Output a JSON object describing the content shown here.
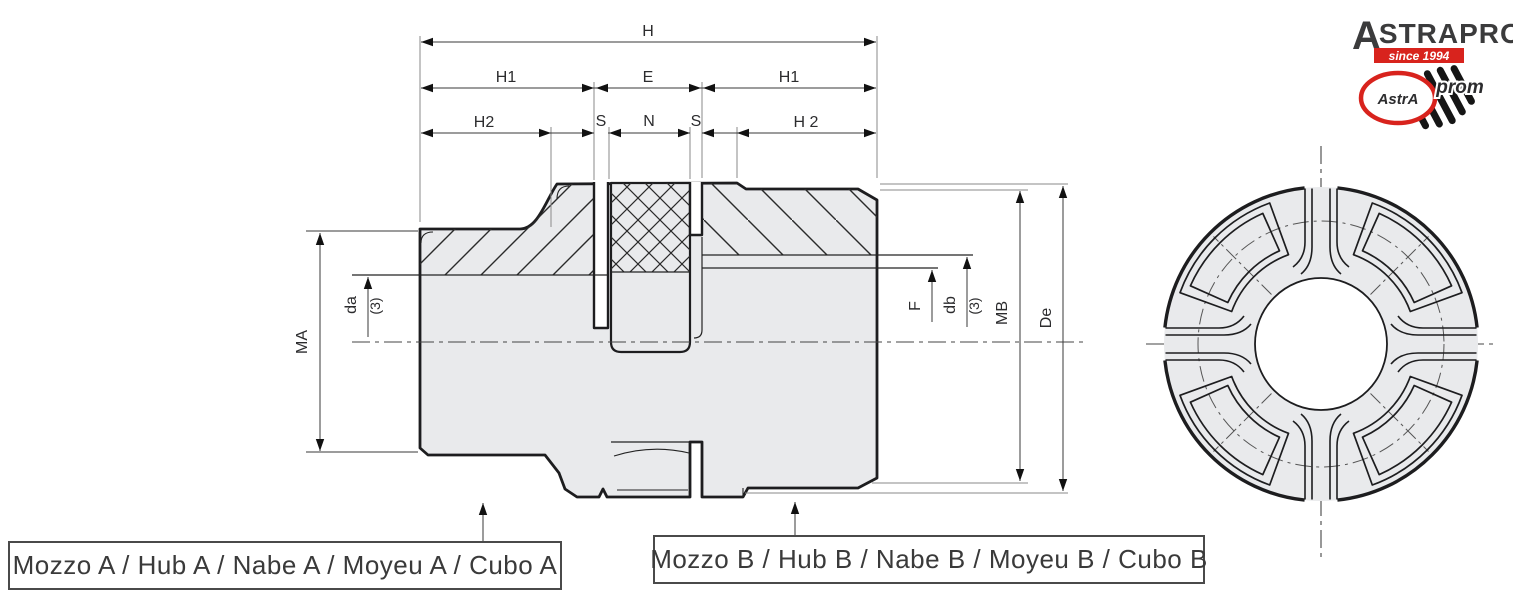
{
  "drawing_title": "elastic jaw coupling dimensional drawing",
  "colors": {
    "accent_red": "#D8231D",
    "body_fill": "#E9EAEC",
    "outline": "#1D1D1F",
    "dim_line": "#3A3A3A",
    "extension_line": "#8A8A8A",
    "logo_text": "#3B3B3C",
    "background": "#FFFFFF"
  },
  "dimensions": {
    "h": "H",
    "h1_left": "H1",
    "e": "E",
    "h1_right": "H1",
    "h2_left": "H2",
    "s_left": "S",
    "n": "N",
    "s_right": "S",
    "h2_right": "H 2",
    "ma": "MA",
    "da": "da",
    "da_note": "(3)",
    "f": "F",
    "db": "db",
    "db_note": "(3)",
    "mb": "MB",
    "de": "De"
  },
  "callouts": {
    "hub_a": "Mozzo A / Hub A / Nabe A / Moyeu A / Cubo A",
    "hub_b": "Mozzo B / Hub B / Nabe B / Moyeu B / Cubo B"
  },
  "logo": {
    "brand_initial": "A",
    "brand_rest": "STRAPROM",
    "brand_suffix": "d.o.o.",
    "tagline": "since 1994",
    "emblem_primary": "AstrA",
    "emblem_secondary": "prom"
  }
}
